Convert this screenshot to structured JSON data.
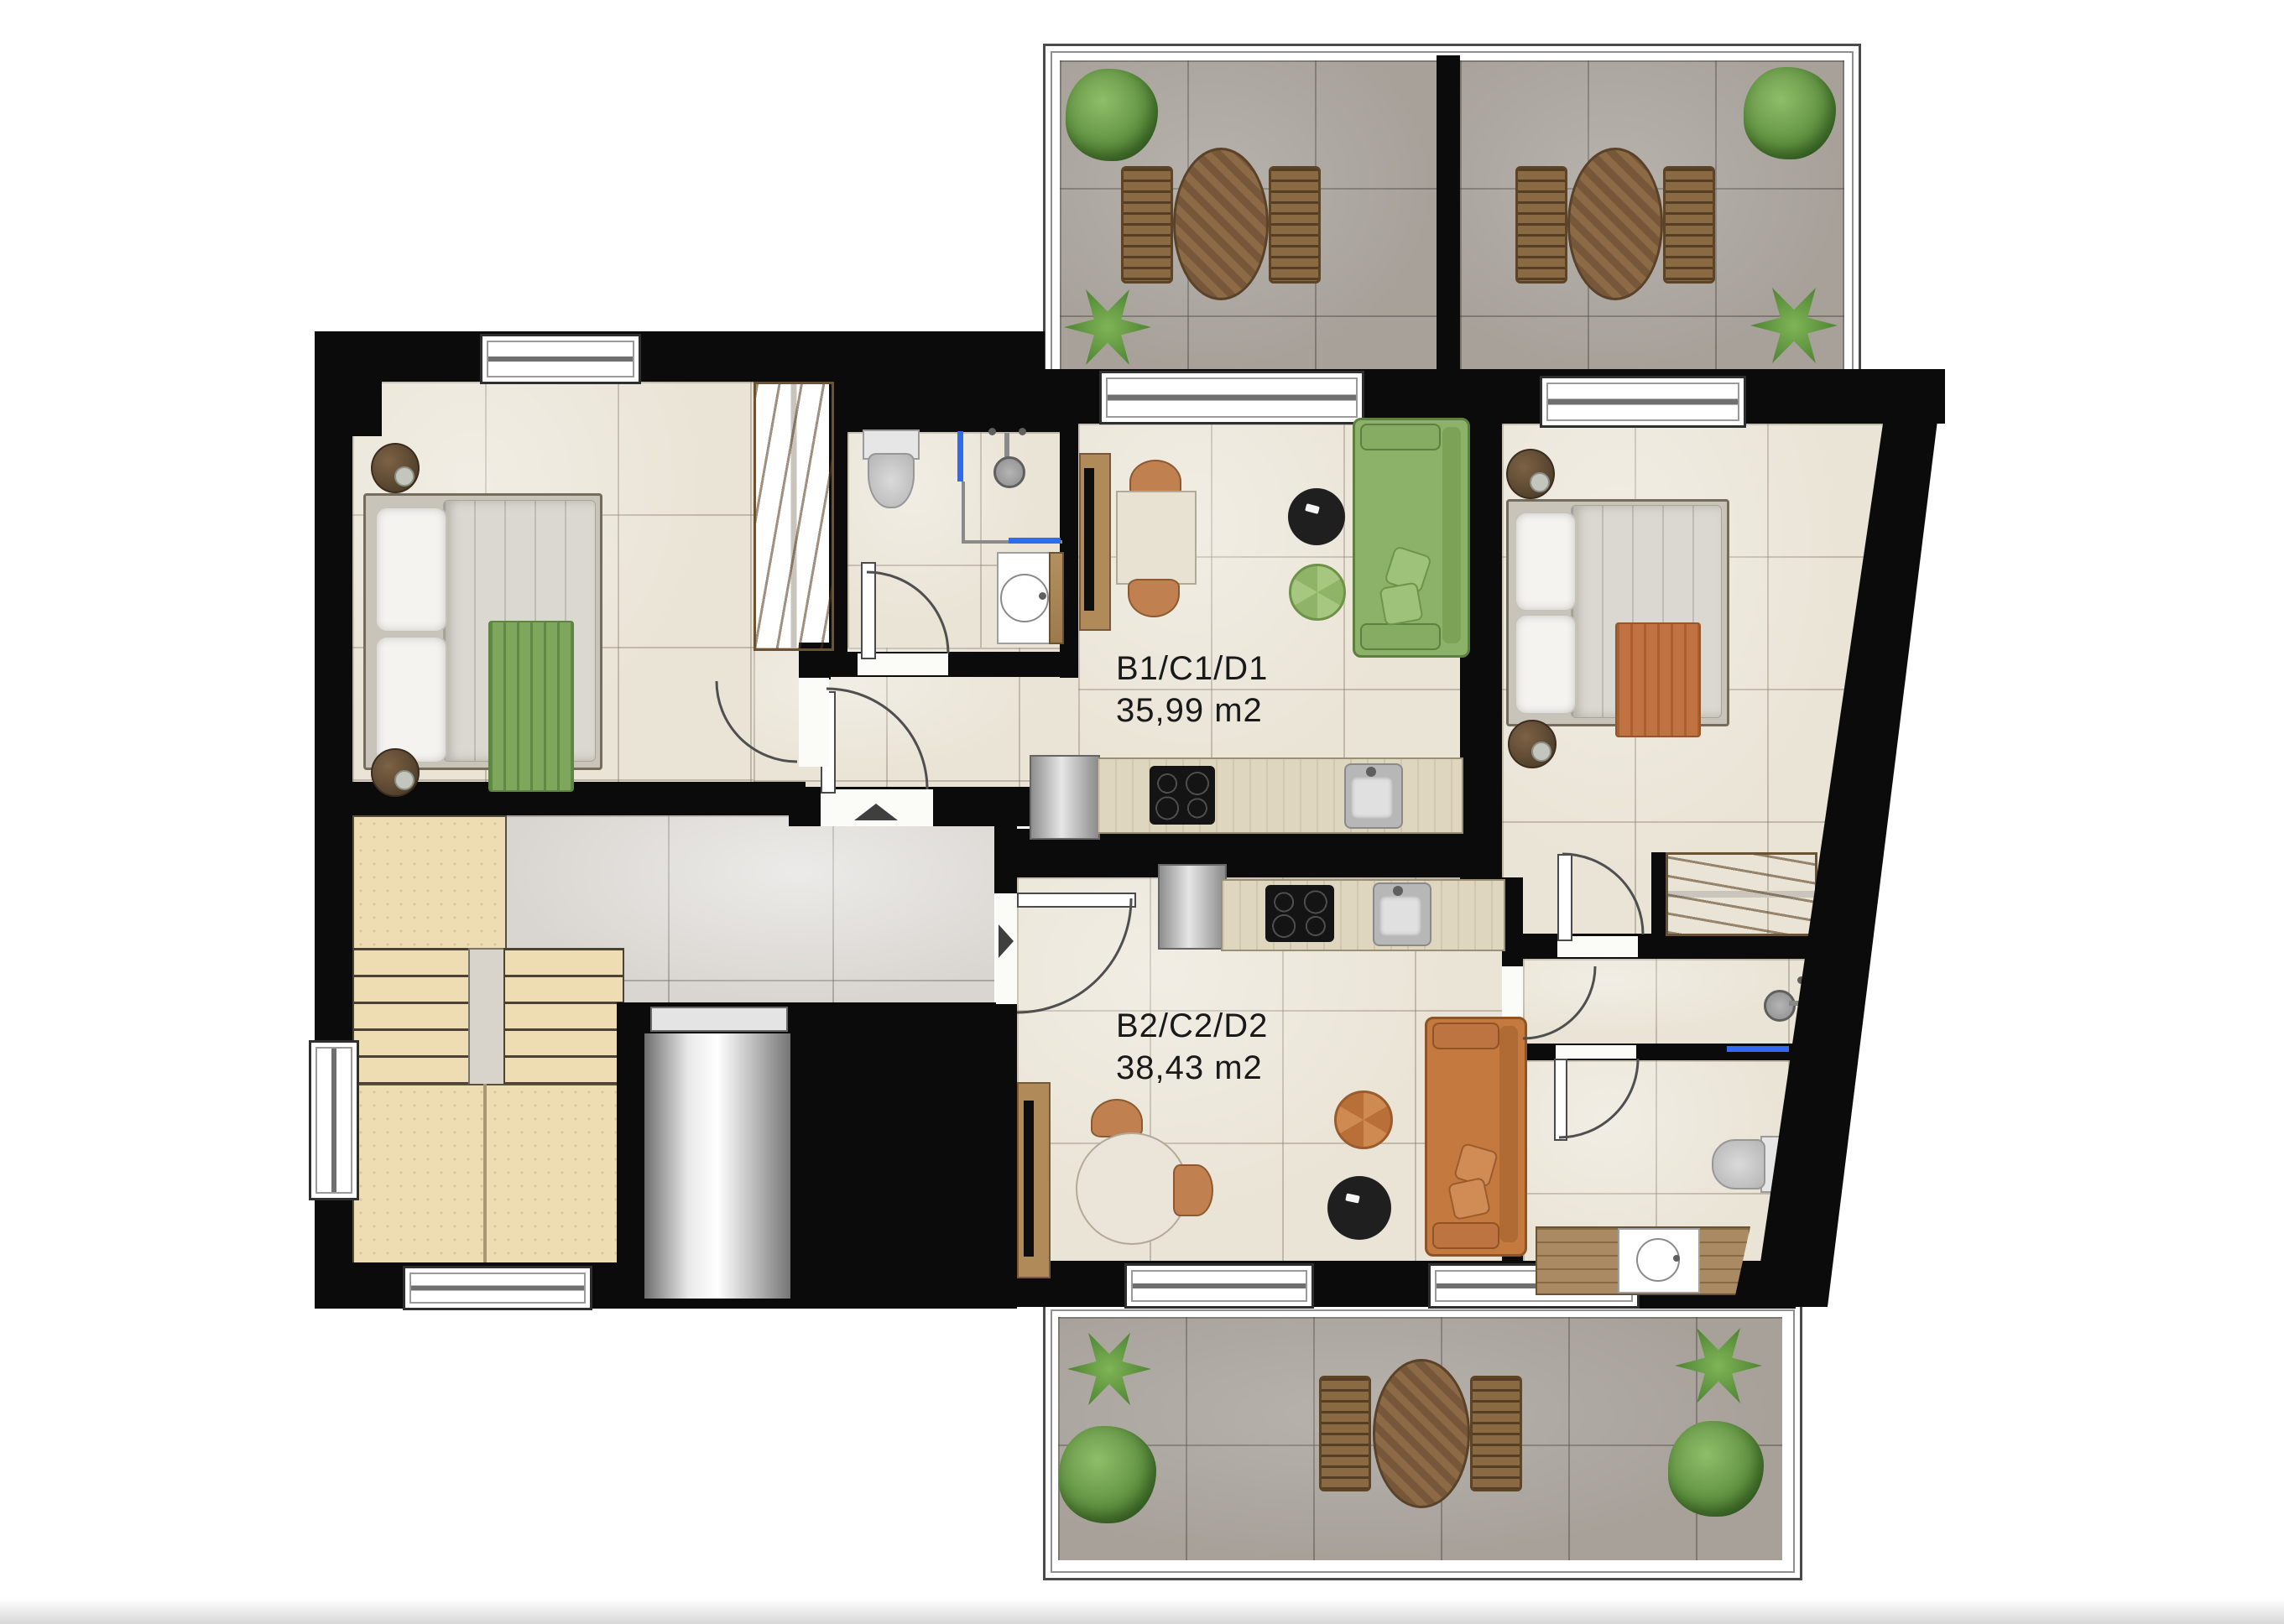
{
  "plan": {
    "type": "residential floor plan",
    "apartments": {
      "a1": {
        "name": "B1/C1/D1",
        "area": "35,99 m2"
      },
      "a2": {
        "name": "B2/C2/D2",
        "area": "38,43 m2"
      }
    },
    "colors": {
      "wall": "#0b0b0b",
      "apartment_floor": "#eae4d6",
      "hallway_floor": "#d9d6d1",
      "terrace_floor": "#a7a19a",
      "stairs": "#eedcb2",
      "wood": "#b2905f",
      "kitchen_counter": "#ded6bf",
      "sofa_apartment1": "#8cb168",
      "sofa_apartment2": "#c4793f",
      "throw_apartment1": "#7ea75d",
      "throw_apartment2": "#c07240",
      "shower_glass": "#2e6bf0",
      "metal": "#c9c9c9"
    }
  }
}
